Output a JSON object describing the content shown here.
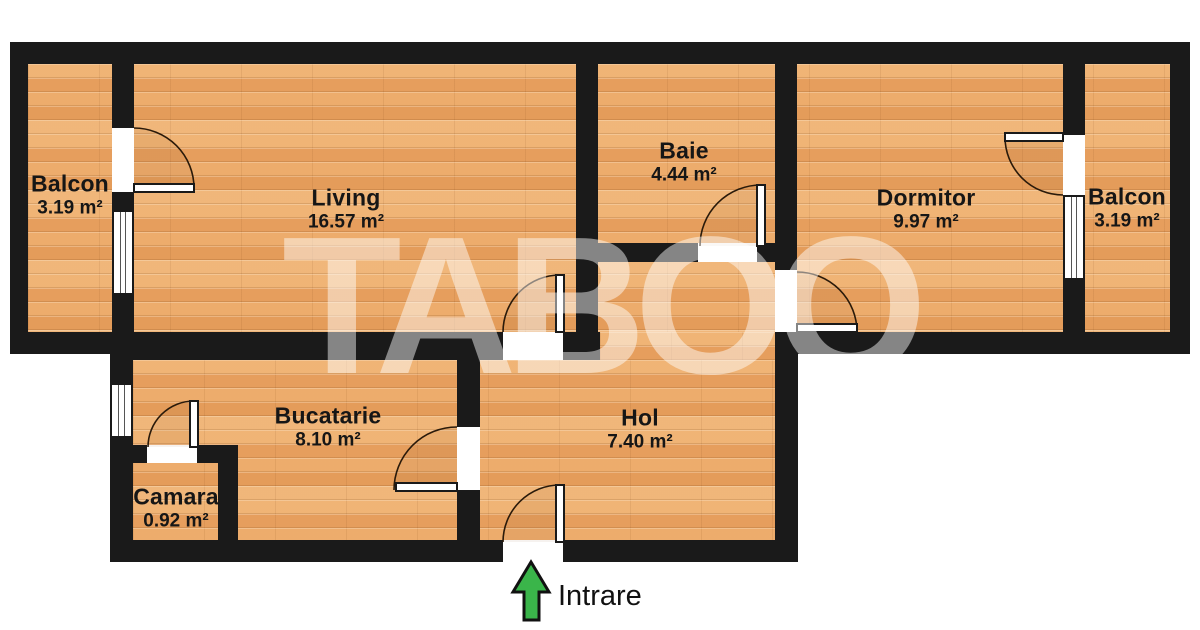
{
  "floorplan": {
    "watermark": "TABOO",
    "entrance_label": "Intrare",
    "rooms": [
      {
        "id": "balcon-left",
        "name": "Balcon",
        "area": "3.19 m²"
      },
      {
        "id": "living",
        "name": "Living",
        "area": "16.57 m²"
      },
      {
        "id": "baie",
        "name": "Baie",
        "area": "4.44 m²"
      },
      {
        "id": "dormitor",
        "name": "Dormitor",
        "area": "9.97 m²"
      },
      {
        "id": "balcon-right",
        "name": "Balcon",
        "area": "3.19 m²"
      },
      {
        "id": "bucatarie",
        "name": "Bucatarie",
        "area": "8.10 m²"
      },
      {
        "id": "camara",
        "name": "Camara",
        "area": "0.92 m²"
      },
      {
        "id": "hol",
        "name": "Hol",
        "area": "7.40 m²"
      }
    ],
    "colors": {
      "wall": "#1a1a1a",
      "floor_wood": "#e9a766",
      "entrance_arrow_green": "#3ab54a",
      "watermark_white": "rgba(255,255,255,0.47)",
      "background": "#ffffff"
    }
  }
}
